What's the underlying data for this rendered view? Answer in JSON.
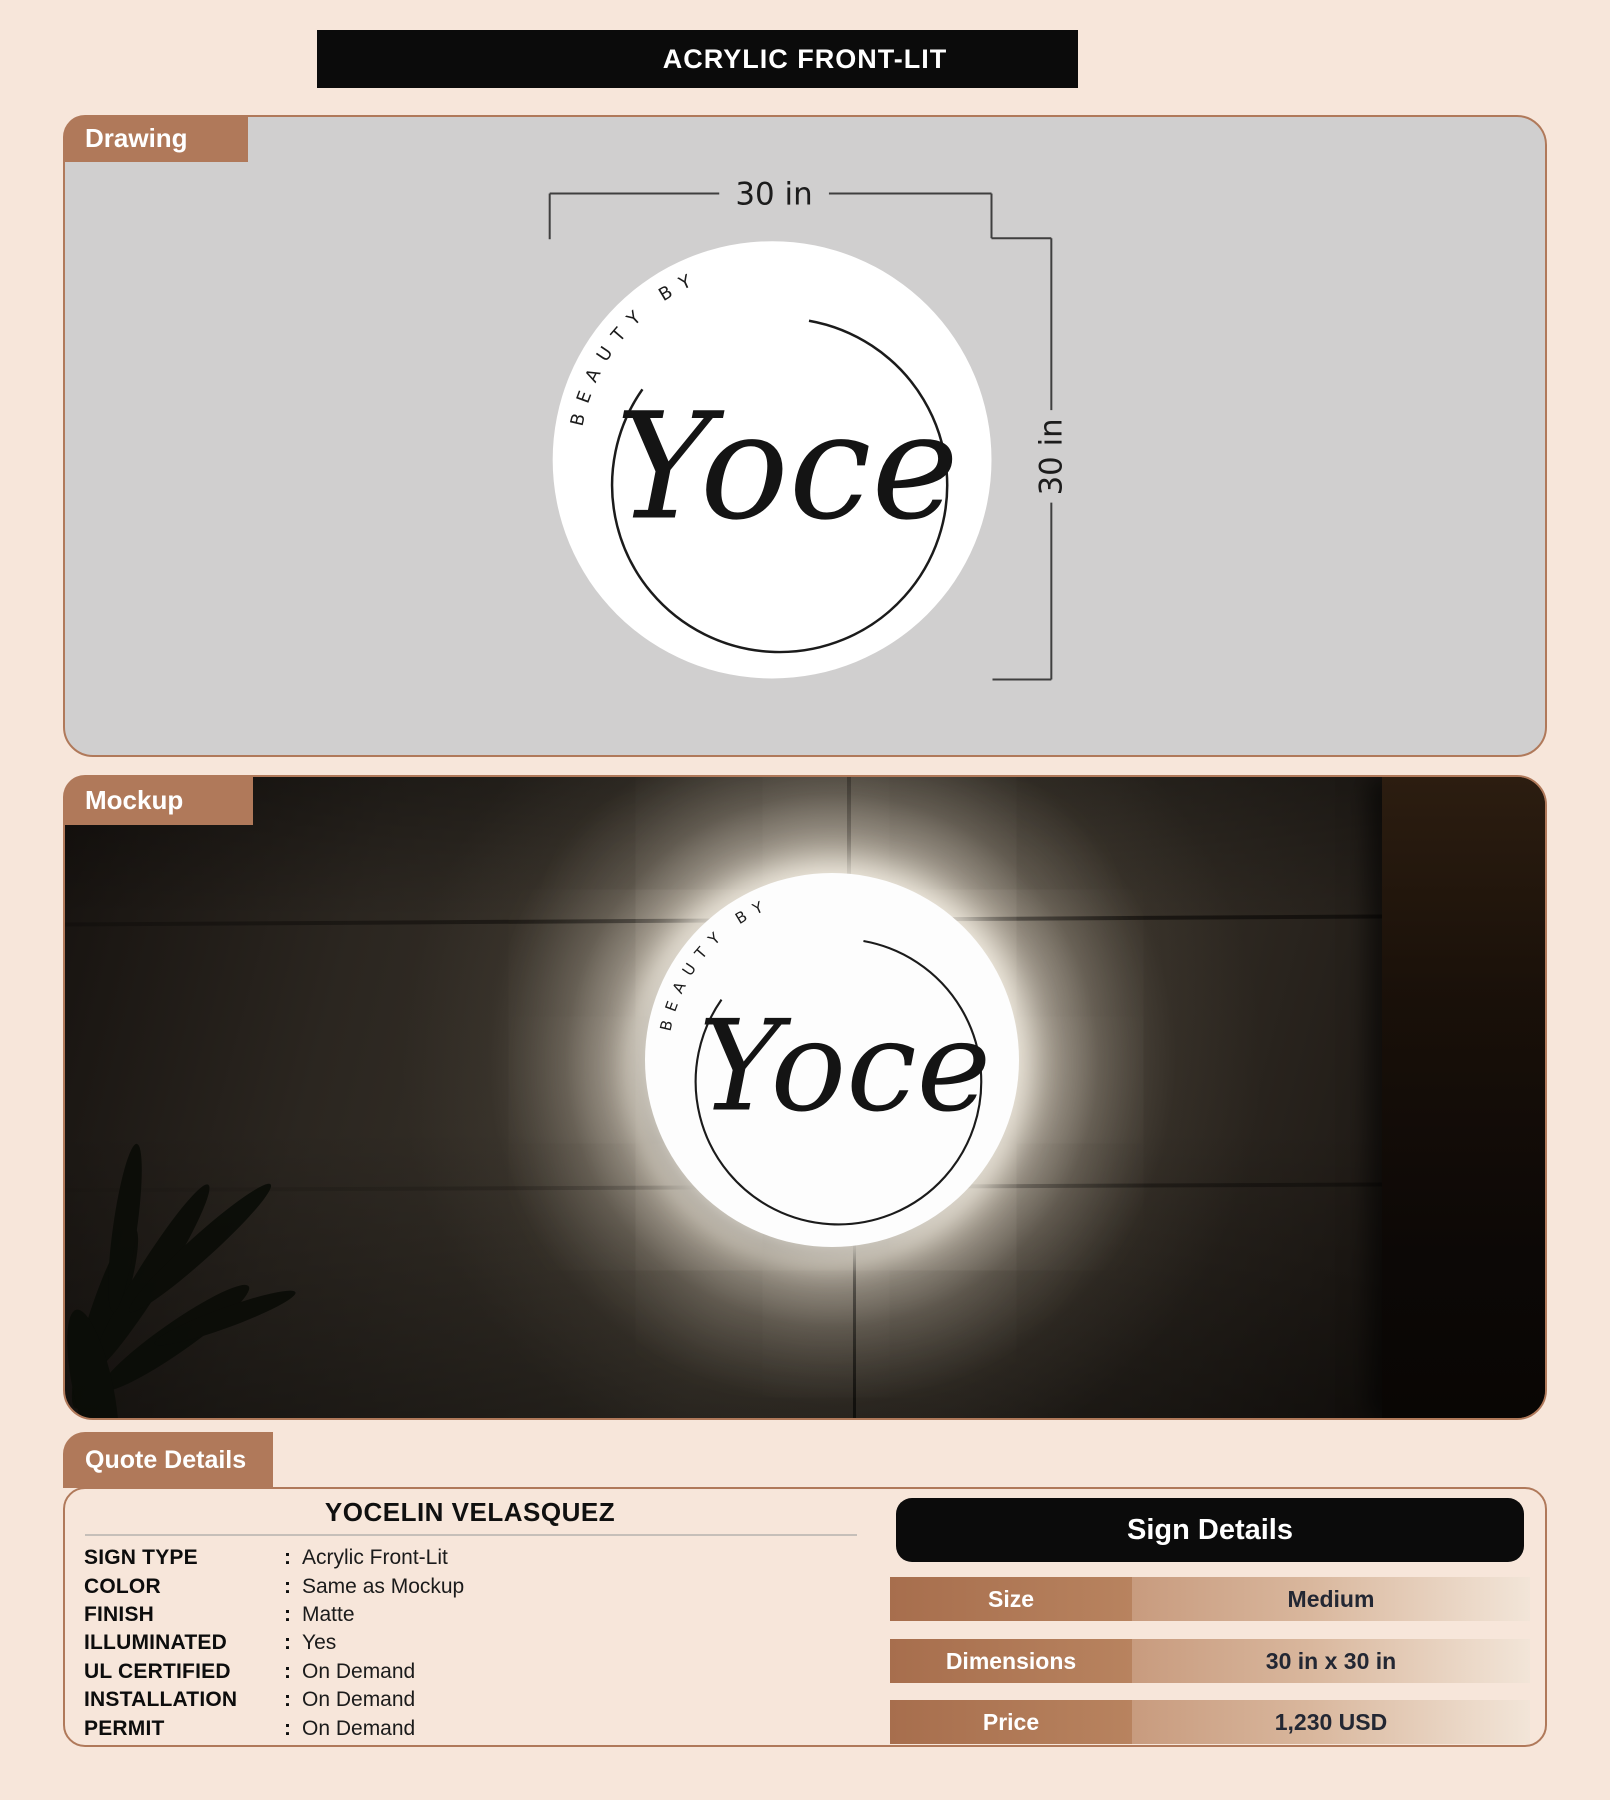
{
  "title_banner": {
    "text": "ACRYLIC FRONT-LIT"
  },
  "drawing": {
    "tab": "Drawing",
    "width_dim": "30 in",
    "height_dim": "30 in"
  },
  "logo": {
    "arc_text": "BEAUTY BY",
    "script_text": "Yoce"
  },
  "mockup": {
    "tab": "Mockup"
  },
  "quote": {
    "tab": "Quote Details",
    "customer_name": "YOCELIN VELASQUEZ",
    "separator": ":",
    "fields": [
      {
        "label": "SIGN TYPE",
        "value": "Acrylic Front-Lit"
      },
      {
        "label": "COLOR",
        "value": "Same as Mockup"
      },
      {
        "label": "FINISH",
        "value": "Matte"
      },
      {
        "label": "ILLUMINATED",
        "value": "Yes"
      },
      {
        "label": "UL CERTIFIED",
        "value": "On Demand"
      },
      {
        "label": "INSTALLATION",
        "value": "On Demand"
      },
      {
        "label": "PERMIT",
        "value": "On Demand"
      }
    ]
  },
  "sign_details": {
    "title": "Sign Details",
    "rows": [
      {
        "label": "Size",
        "value": "Medium"
      },
      {
        "label": "Dimensions",
        "value": "30 in x 30 in"
      },
      {
        "label": "Price",
        "value": "1,230 USD"
      }
    ]
  },
  "colors": {
    "page_bg": "#f7e6da",
    "accent_brown": "#b0795a",
    "banner_black": "#0b0b0b",
    "drawing_bg": "#d0cfcf",
    "value_text": "#232733"
  }
}
